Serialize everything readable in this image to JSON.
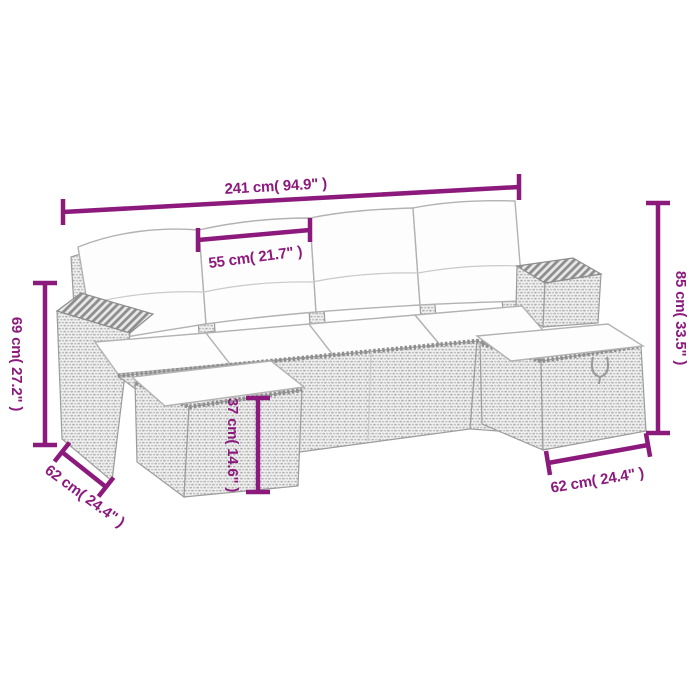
{
  "colors": {
    "dimension_line": "#8c1a7d",
    "dimension_text": "#8c1a7d",
    "background": "#ffffff",
    "rattan_gray": "#ababab",
    "cushion_white": "#fdfdfd"
  },
  "illustration": {
    "description": "line-drawing of a modular rattan garden sofa set with cushions and two ottomans"
  },
  "dimensions": {
    "total_width": {
      "cm": 241,
      "inches": 94.9,
      "label": "241 cm( 94.9\" )"
    },
    "seat_width": {
      "cm": 55,
      "inches": 21.7,
      "label": "55 cm( 21.7\" )"
    },
    "armrest_height": {
      "cm": 69,
      "inches": 27.2,
      "label": "69 cm( 27.2\" )"
    },
    "back_height": {
      "cm": 85,
      "inches": 33.5,
      "label": "85 cm( 33.5\" )"
    },
    "ottoman_height": {
      "cm": 37,
      "inches": 14.6,
      "label": "37 cm( 14.6\" )"
    },
    "left_depth": {
      "cm": 62,
      "inches": 24.4,
      "label": "62 cm( 24.4\" )"
    },
    "right_depth": {
      "cm": 62,
      "inches": 24.4,
      "label": "62 cm( 24.4\" )"
    }
  }
}
